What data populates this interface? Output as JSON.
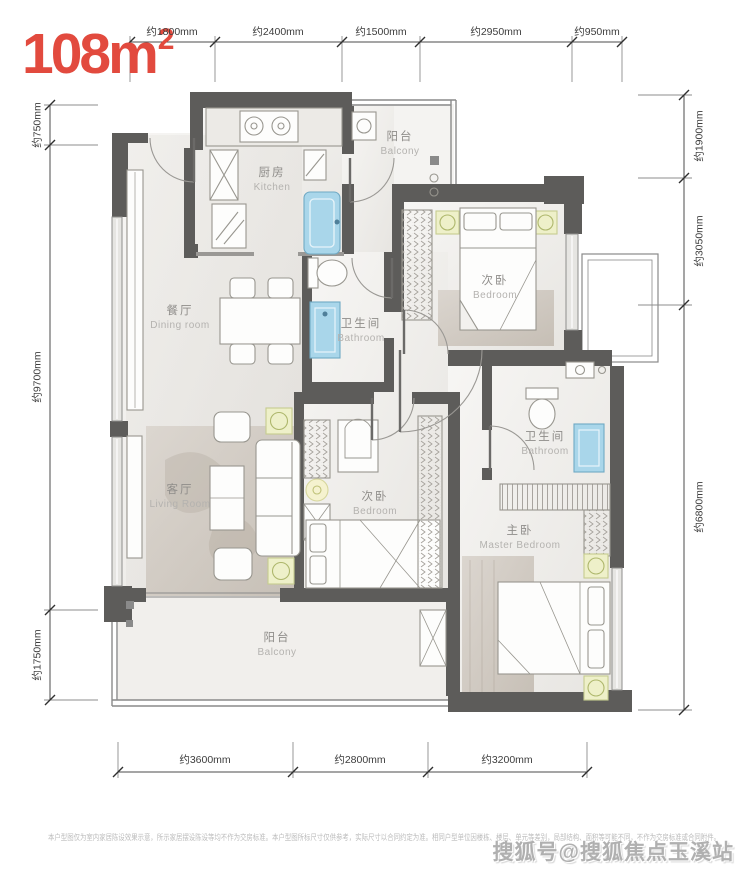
{
  "title": {
    "area": "108m",
    "sup": "2"
  },
  "dimensions": {
    "top": [
      "约1800mm",
      "约2400mm",
      "约1500mm",
      "约2950mm",
      "约950mm"
    ],
    "left": [
      "约750mm",
      "约9700mm",
      "约1750mm"
    ],
    "right": [
      "约1900mm",
      "约3050mm",
      "约6800mm"
    ],
    "bottom": [
      "约3600mm",
      "约2800mm",
      "约3200mm"
    ]
  },
  "rooms": {
    "kitchen": {
      "zh": "厨房",
      "en": "Kitchen"
    },
    "balcony_top": {
      "zh": "阳台",
      "en": "Balcony"
    },
    "bedroom_top": {
      "zh": "次卧",
      "en": "Bedroom"
    },
    "dining": {
      "zh": "餐厅",
      "en": "Dining room"
    },
    "bathroom_mid": {
      "zh": "卫生间",
      "en": "Bathroom"
    },
    "living": {
      "zh": "客厅",
      "en": "Living Room"
    },
    "bedroom_mid": {
      "zh": "次卧",
      "en": "Bedroom"
    },
    "bathroom_master": {
      "zh": "卫生间",
      "en": "Bathroom"
    },
    "master_bedroom": {
      "zh": "主卧",
      "en": "Master Bedroom"
    },
    "balcony_bottom": {
      "zh": "阳台",
      "en": "Balcony"
    }
  },
  "footer": {
    "disclaimer": "本户型图仅为室内家居陈设效果示意，所示家居摆设陈设等均不作为交房标准。本户型图所标尺寸仅供参考，实际尺寸以合同约定为准。相同户型单位因楼栋、楼层、单元等差别，局部结构、面积等可能不同，不作为交房标准或合同附件。",
    "watermark": "搜狐号@搜狐焦点玉溪站"
  },
  "colors": {
    "accent_red": "#e24a3e",
    "wall": "#5d5c5a",
    "fixture_blue": "#a9d6ea",
    "accent_yellow": "#eef0c9"
  }
}
